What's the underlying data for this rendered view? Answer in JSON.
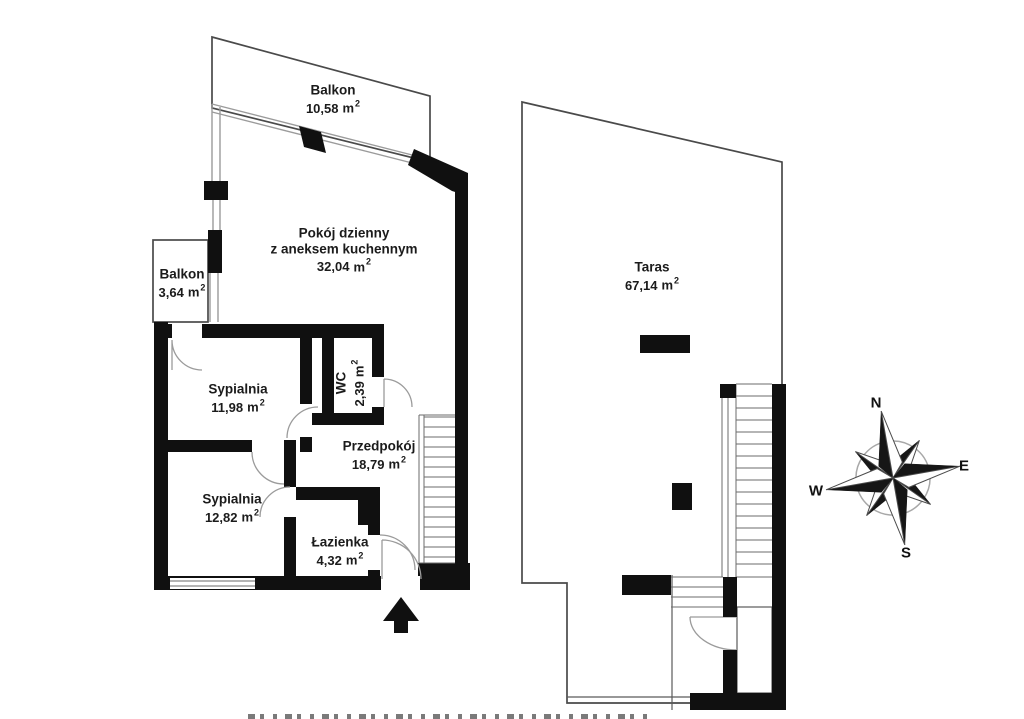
{
  "rooms": [
    {
      "id": "balkon-top",
      "name": "Balkon",
      "area": "10,58"
    },
    {
      "id": "pokoj-dzienny",
      "name": "Pokój dzienny",
      "name2": "z aneksem kuchennym",
      "area": "32,04"
    },
    {
      "id": "balkon-left",
      "name": "Balkon",
      "area": "3,64"
    },
    {
      "id": "sypialnia-1",
      "name": "Sypialnia",
      "area": "11,98"
    },
    {
      "id": "wc",
      "name": "WC",
      "area": "2,39"
    },
    {
      "id": "przedpokoj",
      "name": "Przedpokój",
      "area": "18,79"
    },
    {
      "id": "sypialnia-2",
      "name": "Sypialnia",
      "area": "12,82"
    },
    {
      "id": "lazienka",
      "name": "Łazienka",
      "area": "4,32"
    },
    {
      "id": "taras",
      "name": "Taras",
      "area": "67,14"
    }
  ],
  "units": {
    "area_unit": "m",
    "area_sup": "2"
  },
  "compass": {
    "n": "N",
    "e": "E",
    "s": "S",
    "w": "W"
  },
  "colors": {
    "wall": "#101010",
    "outline": "#4a4a4a",
    "window": "#9b9b9b",
    "text": "#1b1b1b"
  }
}
